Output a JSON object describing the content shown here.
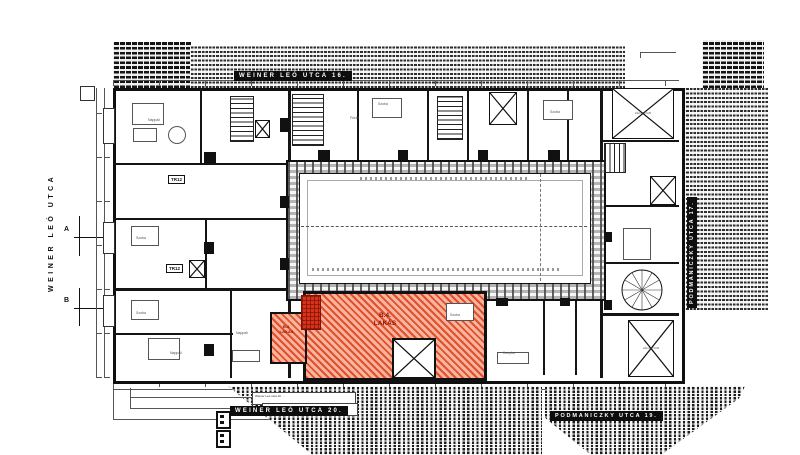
{
  "streets": {
    "left": "WEINER LEÓ UTCA",
    "top": "WEINER LEÓ UTCA 16.",
    "bottom": "WEINER LEÓ UTCA 20.",
    "right": "PODMANICZKY UTCA 17.",
    "bottom_right": "PODMANICZKY UTCA 19."
  },
  "apartments": {
    "b4_id": "B.4.",
    "b4_name": "LAKÁS",
    "b3_id": "B.3.",
    "b3_name": "LAKÁS"
  },
  "markers": {
    "a": "A",
    "b": "B"
  },
  "labels": {
    "tr12": "TR12",
    "legudvar": "LÉGUDVAR"
  },
  "rooms": [
    {
      "label": "Nappali"
    },
    {
      "label": "Szoba"
    },
    {
      "label": "Szoba"
    },
    {
      "label": "Nappali"
    },
    {
      "label": "Szoba"
    },
    {
      "label": "Szoba"
    },
    {
      "label": "Szoba"
    },
    {
      "label": "Nappali"
    },
    {
      "label": "Konyha"
    },
    {
      "label": "Fürdő"
    }
  ],
  "notes": [
    {
      "text": "Weiner Leó utca 20. …"
    },
    {
      "text": "Weiner Leó utca 20. …"
    }
  ],
  "colors": {
    "accent_orange": "#e0502e",
    "wall": "#141414",
    "dim": "#555555"
  }
}
